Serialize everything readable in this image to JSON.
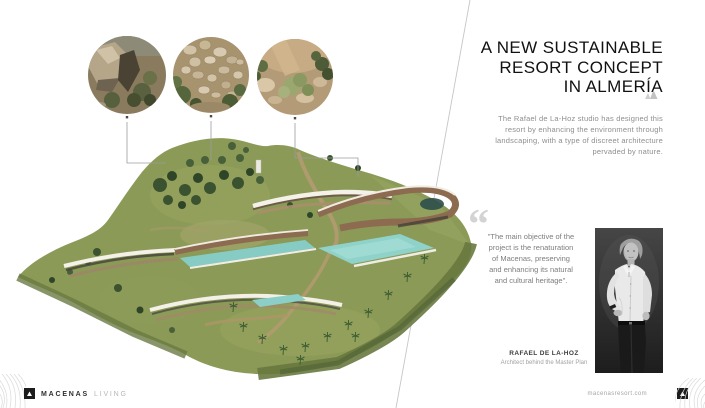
{
  "header": {
    "title_lines": [
      "A NEW SUSTAINABLE",
      "RESORT CONCEPT",
      "IN ALMERÍA"
    ]
  },
  "intro_text": "The Rafael de La-Hoz studio has designed this resort by enhancing the environment through landscaping, with a type of discreet architecture pervaded by nature.",
  "quote": {
    "mark": "“",
    "text": "\"The main objective of the project is the renaturation of Macenas, preserving and enhancing its natural and cultural heritage\"."
  },
  "architect": {
    "name": "RAFAEL DE LA-HOZ",
    "role": "Architect behind the Master Plan"
  },
  "footer": {
    "brand": "MACENAS",
    "brand_suffix": "LIVING",
    "website": "macenasresort.com"
  },
  "figures": {
    "aerial_render": "aerial-masterplan-of-hillside-resort",
    "detail_circle_1": "rocky-outcrop-terrain-detail",
    "detail_circle_2": "dry-stone-texture-detail",
    "detail_circle_3": "scrubland-rocks-detail",
    "portrait": "rafael-de-la-hoz-black-and-white-portrait"
  },
  "colors": {
    "terrain_green": "#8b9a57",
    "terrain_dark_edge": "#68793f",
    "tree_green": "#3b5230",
    "pool_turquoise": "#8fd2ca",
    "building_brown": "#8d6b50",
    "roof_white": "#f4f1e9",
    "path_tan": "#b39b70",
    "title_text": "#111111",
    "body_text": "#8e8e8e",
    "divider_line": "#c6c6c6",
    "logo_dark": "#1c1c1c"
  }
}
